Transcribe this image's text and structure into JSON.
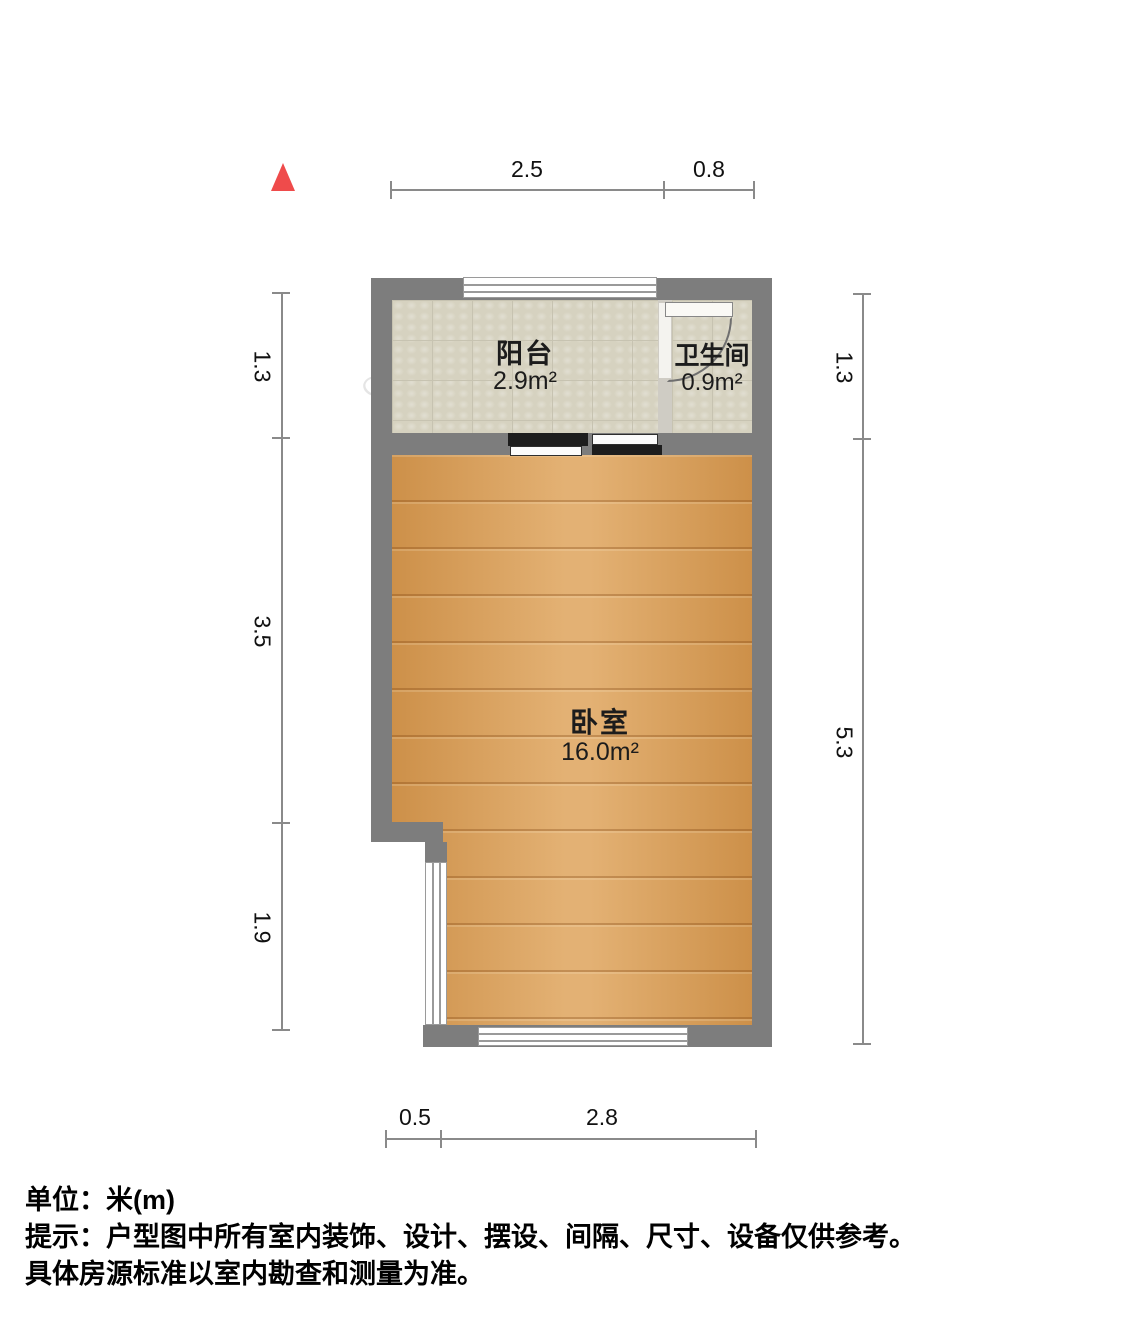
{
  "floorplan": {
    "north_indicator": "north-arrow",
    "rooms": [
      {
        "name": "阳台",
        "area": "2.9m²"
      },
      {
        "name": "卫生间",
        "area": "0.9m²"
      },
      {
        "name": "卧室",
        "area": "16.0m²"
      }
    ],
    "dimensions": {
      "top": [
        "2.5",
        "0.8"
      ],
      "left": [
        "1.3",
        "3.5",
        "1.9"
      ],
      "right": [
        "1.3",
        "5.3"
      ],
      "bottom": [
        "0.5",
        "2.8"
      ]
    },
    "watermarks": [
      "Q房网",
      "Q房网",
      "正顺好房",
      "正顺好房",
      "Q房网"
    ],
    "colors": {
      "wall": "#7d7d7d",
      "wood_floor": "#dda055",
      "tile_floor": "#d6d2c0",
      "north_arrow": "#ef4b4b",
      "dimension_line": "#8a8a8a"
    }
  },
  "footer": {
    "unit": "单位：米(m)",
    "tip": "提示：户型图中所有室内装饰、设计、摆设、间隔、尺寸、设备仅供参考。",
    "tip2": "具体房源标准以室内勘查和测量为准。"
  }
}
